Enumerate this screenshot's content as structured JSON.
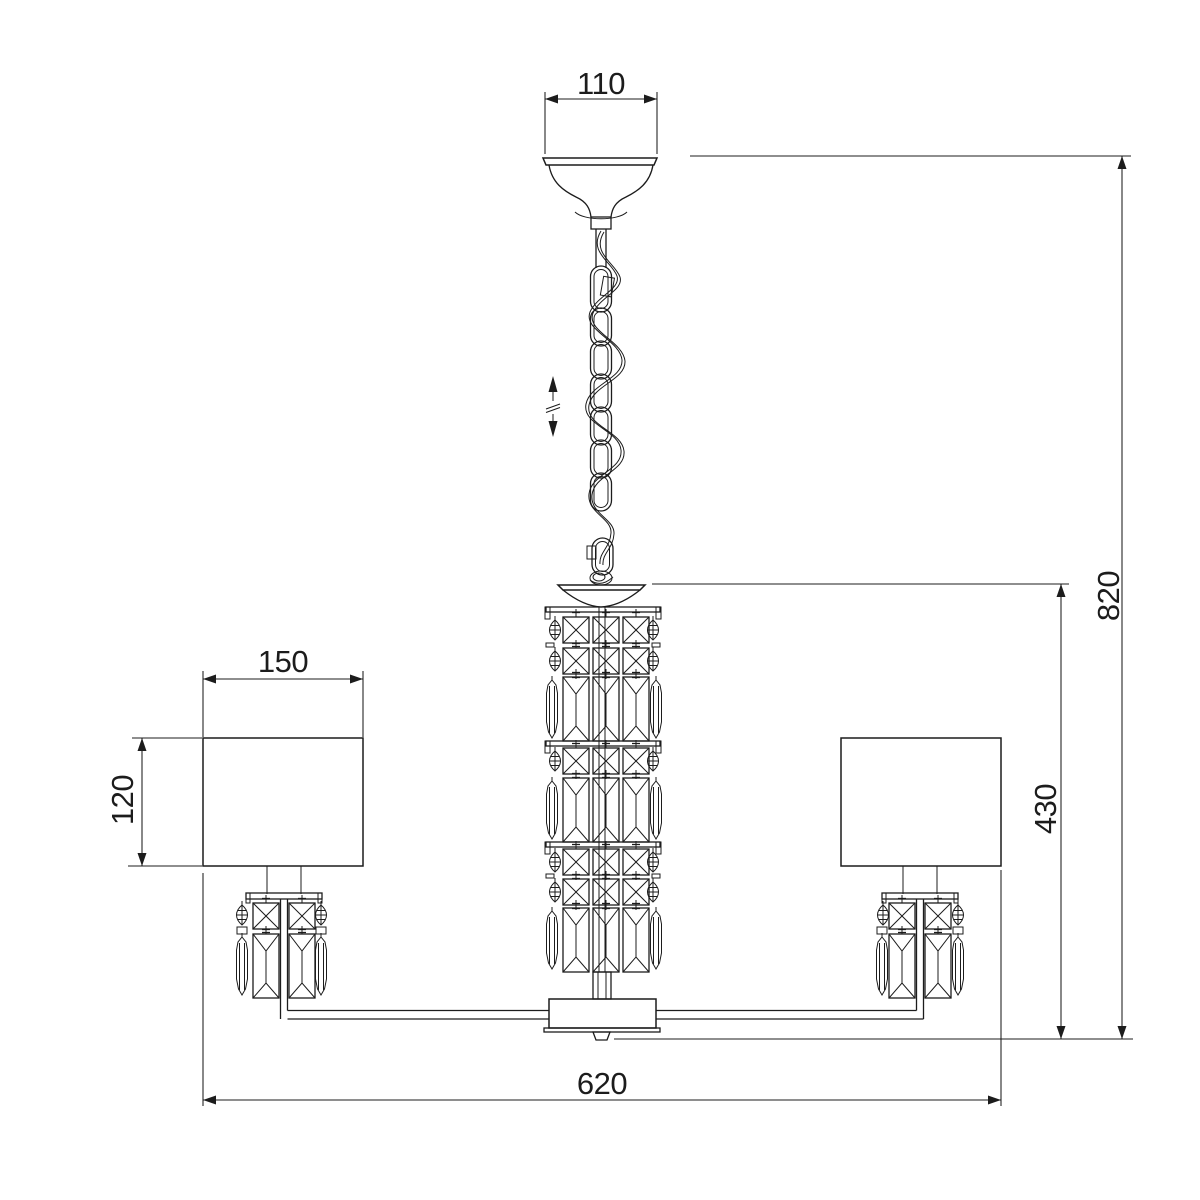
{
  "page": {
    "background": "#ffffff",
    "line_color": "#1c1c1c",
    "content": "chandelier-technical-dimension-drawing"
  },
  "dimensions": {
    "canopy_width": "110",
    "shade_width": "150",
    "shade_height": "120",
    "overall_width": "620",
    "body_height": "430",
    "overall_height": "820"
  },
  "icons": {
    "height_adjust": "double-vertical-arrow-with-break"
  }
}
